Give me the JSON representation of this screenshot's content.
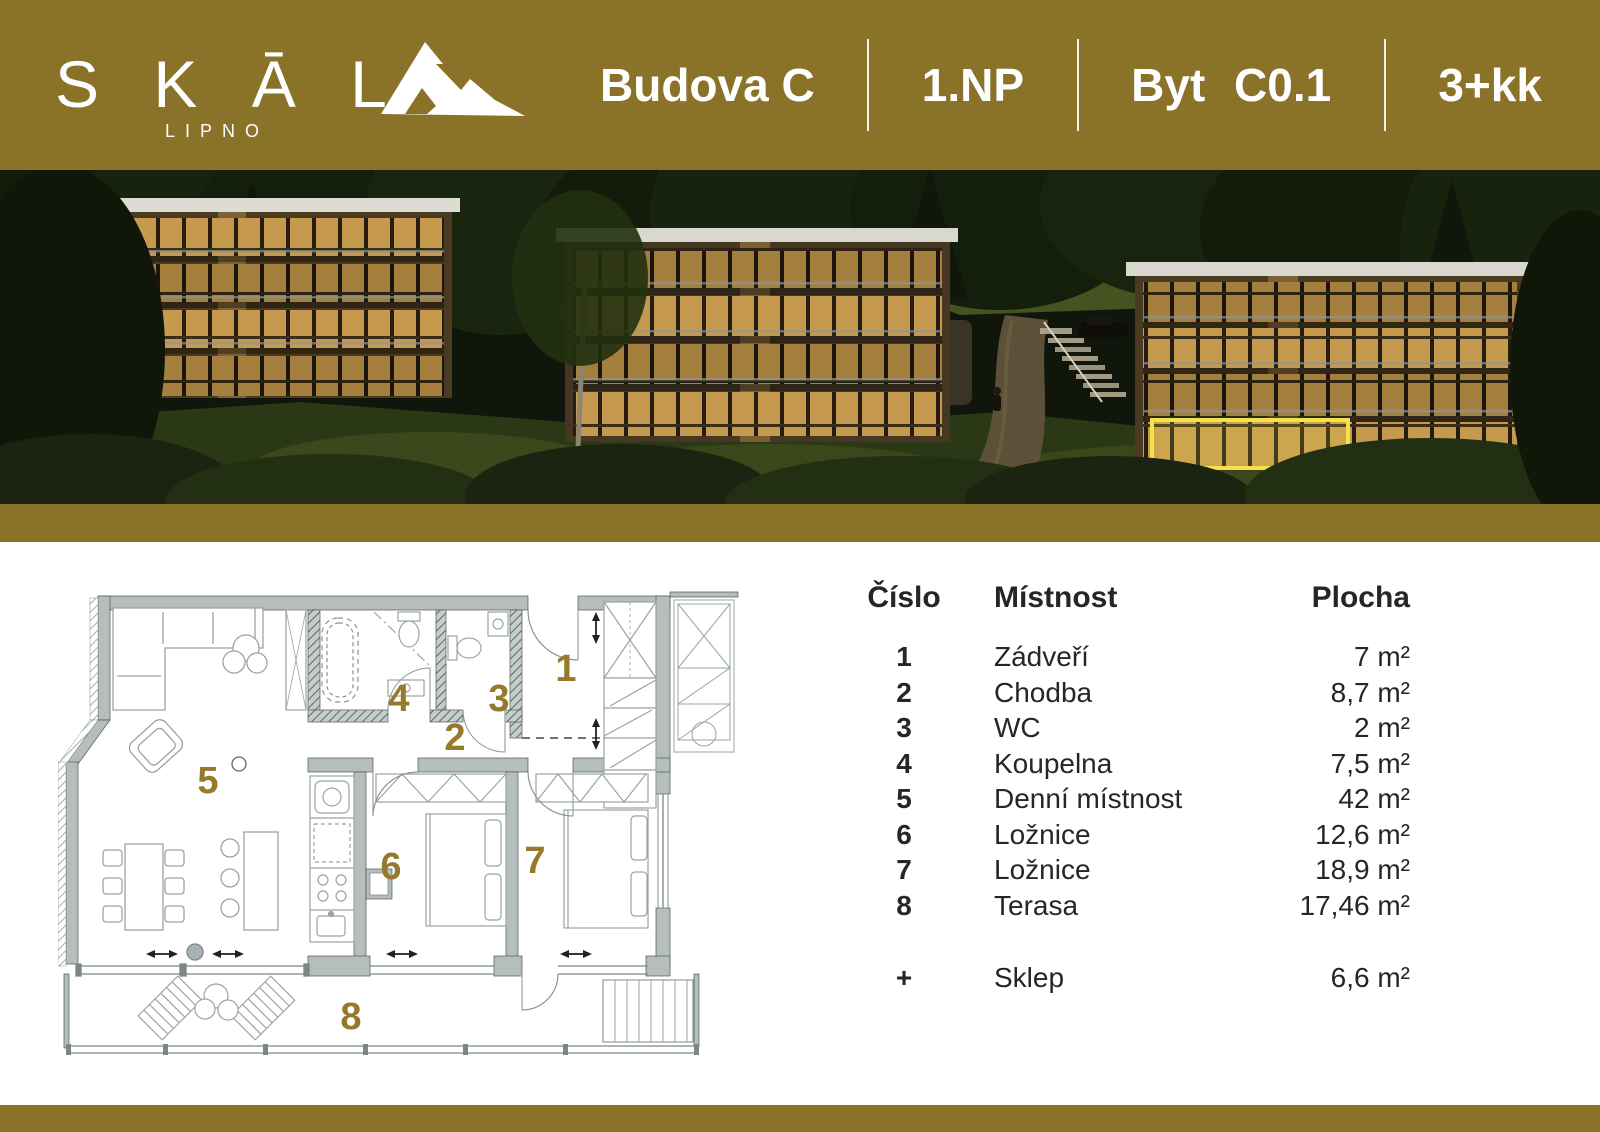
{
  "colors": {
    "brand_gold": "#8a7228",
    "plan_number_gold": "#97792c",
    "highlight_yellow": "#f2e348"
  },
  "header": {
    "logo_text": "S K Ā L",
    "logo_sub": "LIPNO",
    "title_parts": [
      "Budova C",
      "1.NP",
      "Byt C0.1",
      "3+kk"
    ]
  },
  "floor_plan": {
    "room_numbers": [
      "1",
      "2",
      "3",
      "4",
      "5",
      "6",
      "7",
      "8"
    ]
  },
  "table": {
    "columns": [
      "Číslo",
      "Místnost",
      "Plocha"
    ],
    "rows": [
      {
        "num": "1",
        "name": "Zádveří",
        "area": "7 m²"
      },
      {
        "num": "2",
        "name": "Chodba",
        "area": "8,7 m²"
      },
      {
        "num": "3",
        "name": "WC",
        "area": "2 m²"
      },
      {
        "num": "4",
        "name": "Koupelna",
        "area": "7,5 m²"
      },
      {
        "num": "5",
        "name": "Denní místnost",
        "area": "42 m²"
      },
      {
        "num": "6",
        "name": "Ložnice",
        "area": "12,6 m²"
      },
      {
        "num": "7",
        "name": "Ložnice",
        "area": "18,9 m²"
      },
      {
        "num": "8",
        "name": "Terasa",
        "area": "17,46 m²"
      }
    ],
    "extra_row": {
      "num": "+",
      "name": "Sklep",
      "area": "6,6 m²"
    }
  }
}
